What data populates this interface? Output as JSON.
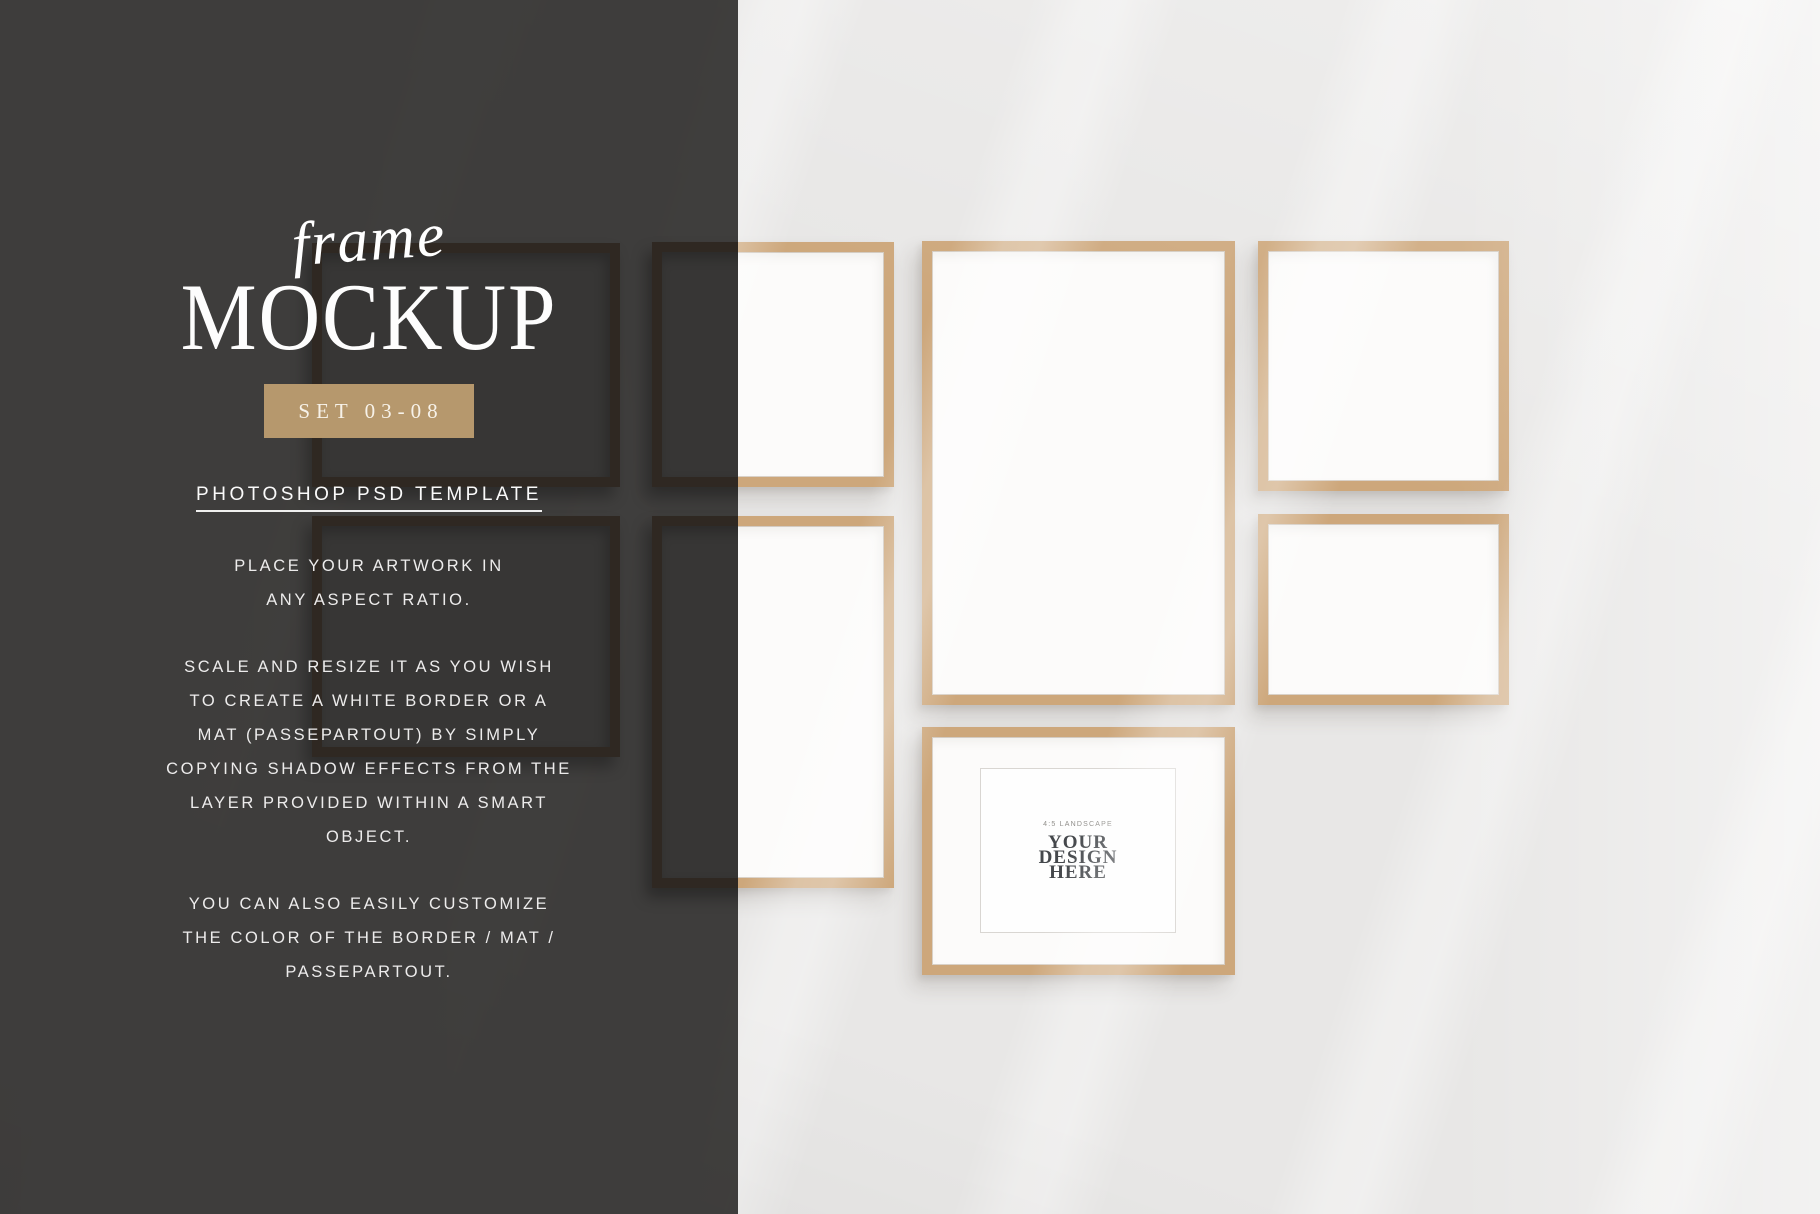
{
  "panel": {
    "title_script": "frame",
    "title_main": "MOCKUP",
    "badge": "SET 03-08",
    "subtitle": "PHOTOSHOP PSD TEMPLATE",
    "p1": [
      "PLACE YOUR ARTWORK IN",
      "ANY ASPECT RATIO."
    ],
    "p2": [
      "SCALE AND RESIZE IT AS YOU WISH",
      "TO CREATE A WHITE BORDER OR A",
      "MAT (PASSEPARTOUT) BY SIMPLY",
      "COPYING SHADOW EFFECTS FROM THE",
      "LAYER PROVIDED WITHIN A SMART",
      "OBJECT."
    ],
    "p3": [
      "YOU CAN ALSO EASILY CUSTOMIZE",
      "THE COLOR OF THE BORDER / MAT /",
      "PASSEPARTOUT."
    ]
  },
  "design_placeholder": {
    "caption": "4:5 LANDSCAPE",
    "lines": [
      "YOUR",
      "DESIGN",
      "HERE"
    ]
  },
  "colors": {
    "wall": "#e8e7e6",
    "panel": "#3b3a39",
    "wood": "#cda77b",
    "dark_wood": "#2f2822",
    "badge": "#b6986d",
    "label_text": "#45484c"
  }
}
